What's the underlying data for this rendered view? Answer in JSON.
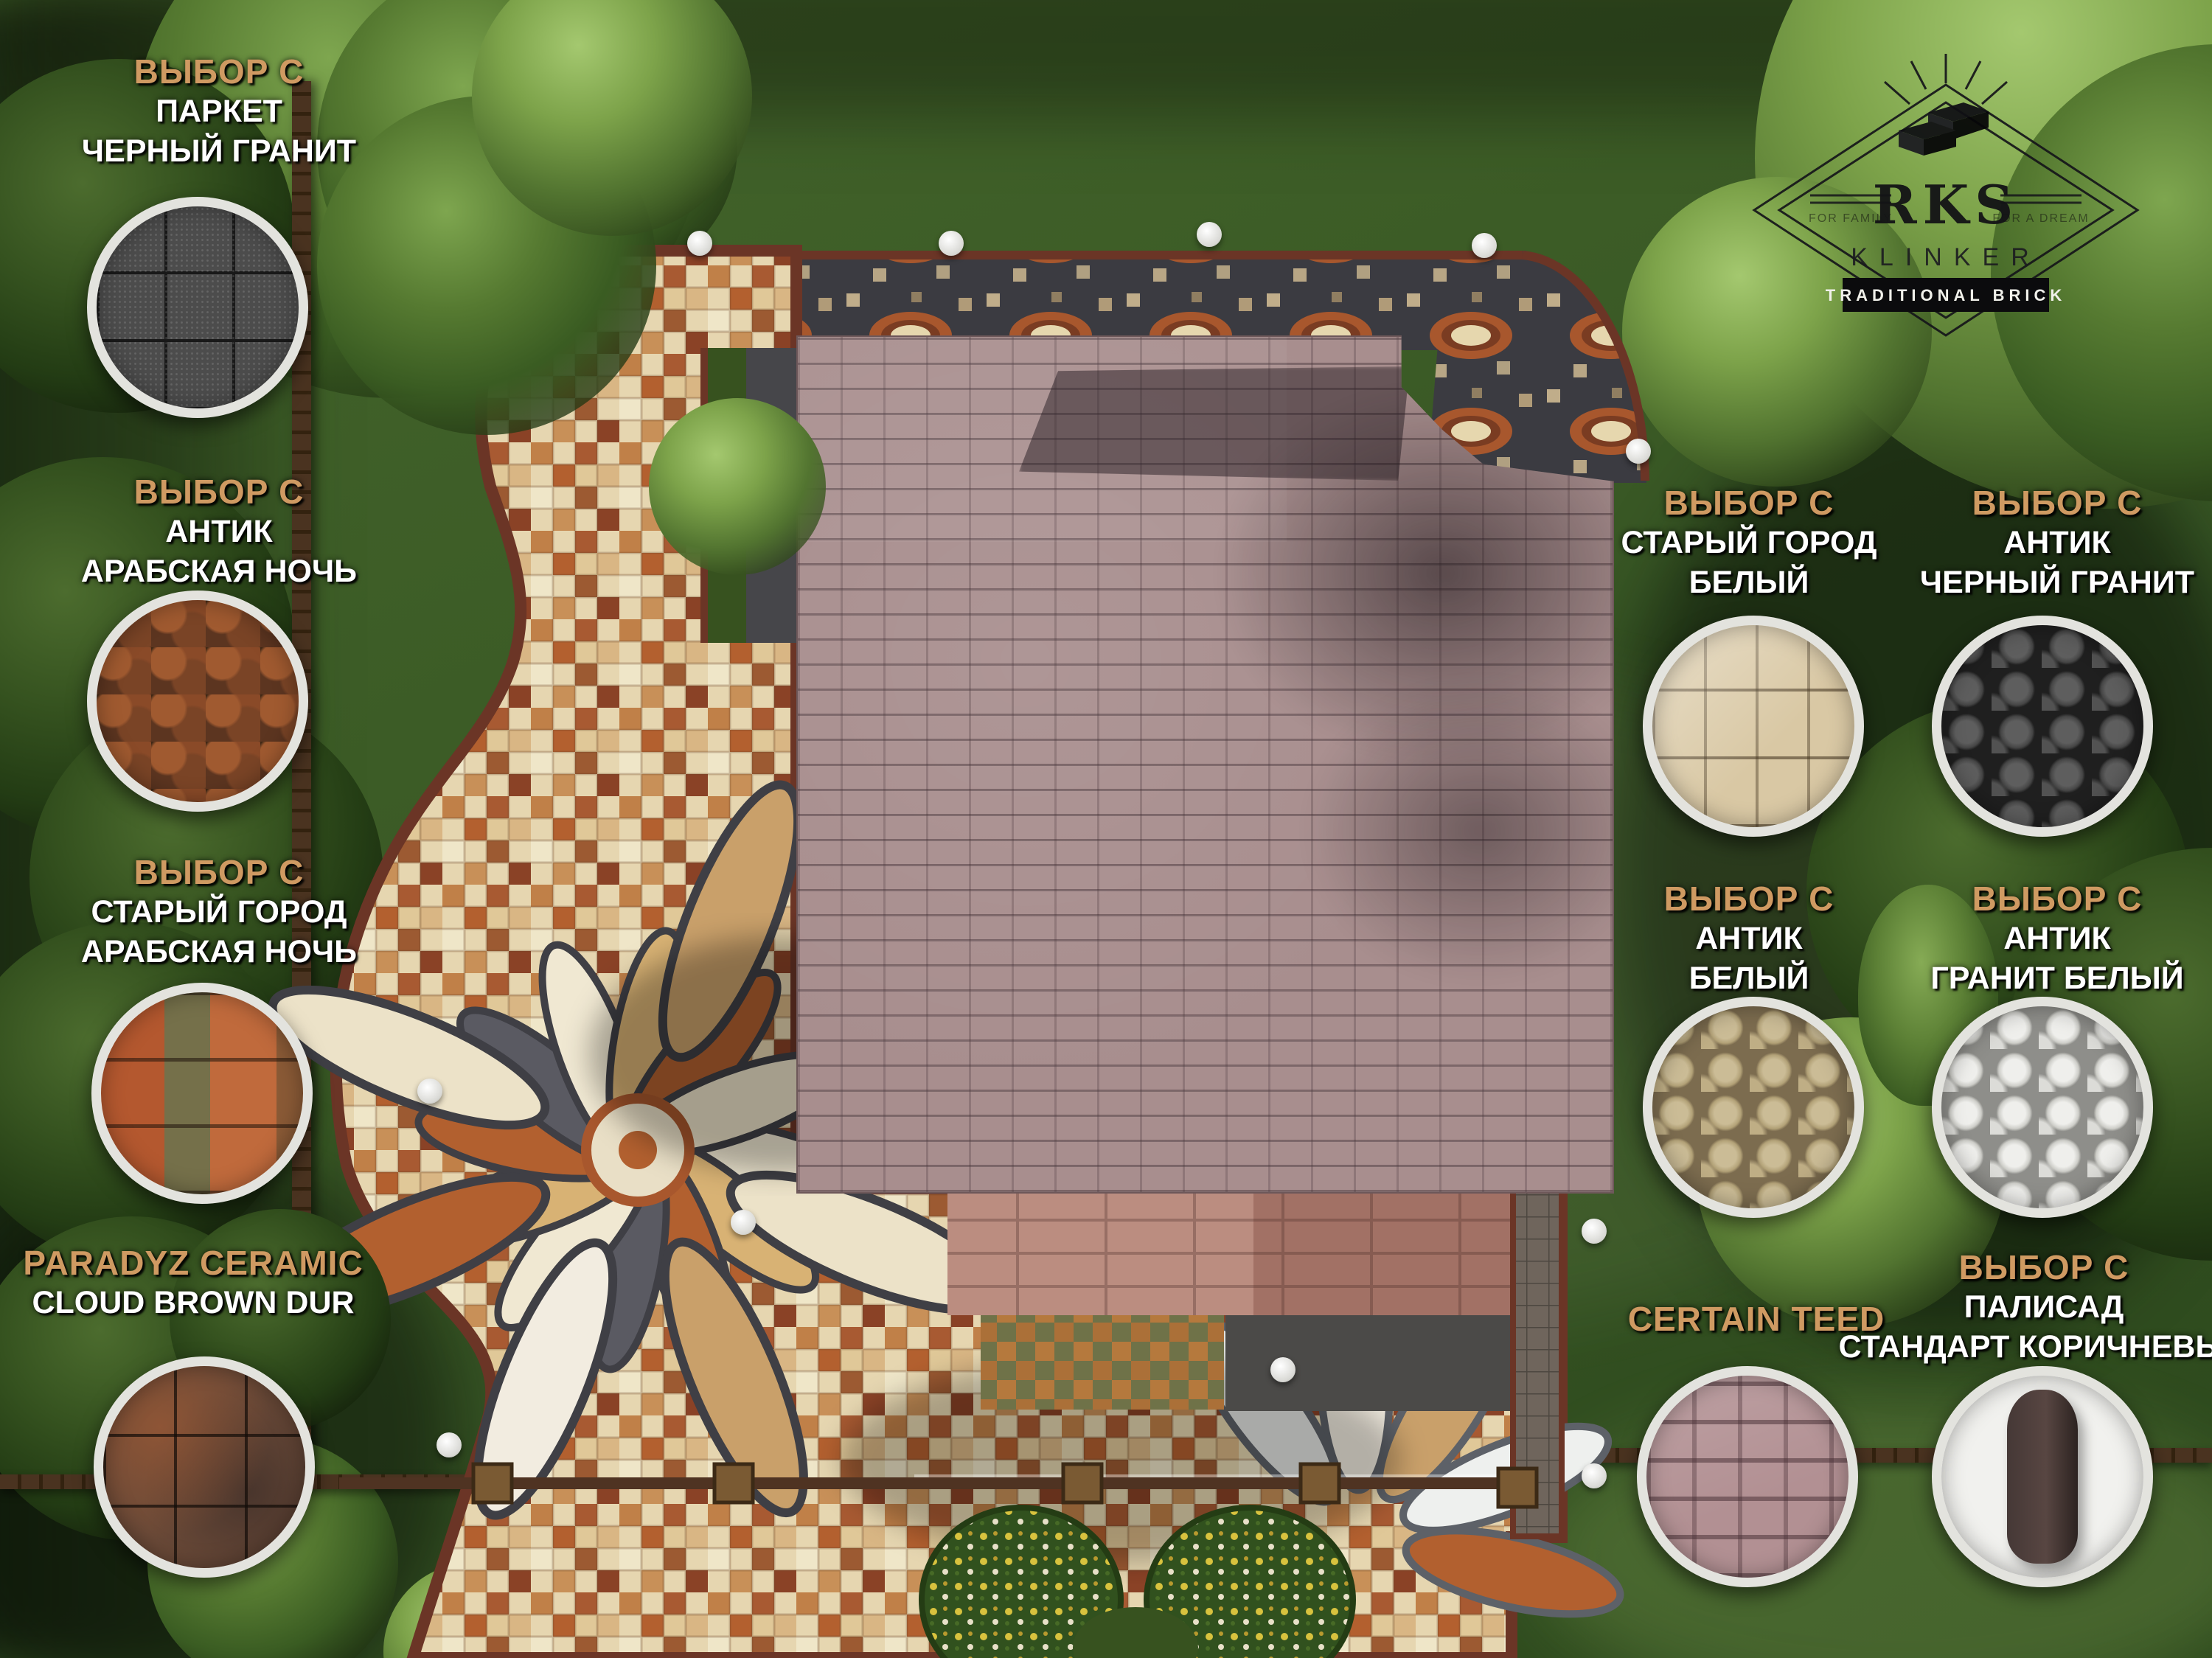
{
  "scene": {
    "title": "landscape paving design plan - top view render",
    "colors": {
      "accent_orange": "#cf9a62",
      "label_white": "#ffffff",
      "grass": "#3c5c26",
      "roof": "#a88e8e",
      "mosaic_cream": "#e6d6b0",
      "mosaic_rust": "#b05c2c",
      "mosaic_slate": "#3c3c42",
      "edging": "#6b3526"
    }
  },
  "logo": {
    "name": "RKS",
    "sub": "KLINKER",
    "banner": "TRADITIONAL BRICK",
    "left_tag": "FOR FAMILY",
    "right_tag": "FOR A DREAM",
    "icon": "bricks-with-rays"
  },
  "materials": [
    {
      "id": "parquet-black-granite",
      "brand": "ВЫБОР С",
      "name": "ПАРКЕТ",
      "variant": "ЧЕРНЫЙ ГРАНИТ"
    },
    {
      "id": "antik-arabian-night",
      "brand": "ВЫБОР С",
      "name": "АНТИК",
      "variant": "АРАБСКАЯ НОЧЬ"
    },
    {
      "id": "old-town-arabian-night",
      "brand": "ВЫБОР С",
      "name": "СТАРЫЙ ГОРОД",
      "variant": "АРАБСКАЯ НОЧЬ"
    },
    {
      "id": "paradyz-cloud-brown",
      "brand": "PARADYZ CERAMIC",
      "name": "CLOUD BROWN DUR",
      "variant": ""
    },
    {
      "id": "old-town-white",
      "brand": "ВЫБОР С",
      "name": "СТАРЫЙ ГОРОД",
      "variant": "БЕЛЫЙ"
    },
    {
      "id": "antik-black-granite",
      "brand": "ВЫБОР С",
      "name": "АНТИК",
      "variant": "ЧЕРНЫЙ ГРАНИТ"
    },
    {
      "id": "antik-white",
      "brand": "ВЫБОР С",
      "name": "АНТИК",
      "variant": "БЕЛЫЙ"
    },
    {
      "id": "antik-granite-white",
      "brand": "ВЫБОР С",
      "name": "АНТИК",
      "variant": "ГРАНИТ БЕЛЫЙ"
    },
    {
      "id": "certainteed-shingles",
      "brand": "CERTAIN TEED",
      "name": "",
      "variant": ""
    },
    {
      "id": "palisade-standard-brown",
      "brand": "ВЫБОР С",
      "name": "ПАЛИСАД",
      "variant": "СТАНДАРТ КОРИЧНЕВЫЙ"
    }
  ]
}
